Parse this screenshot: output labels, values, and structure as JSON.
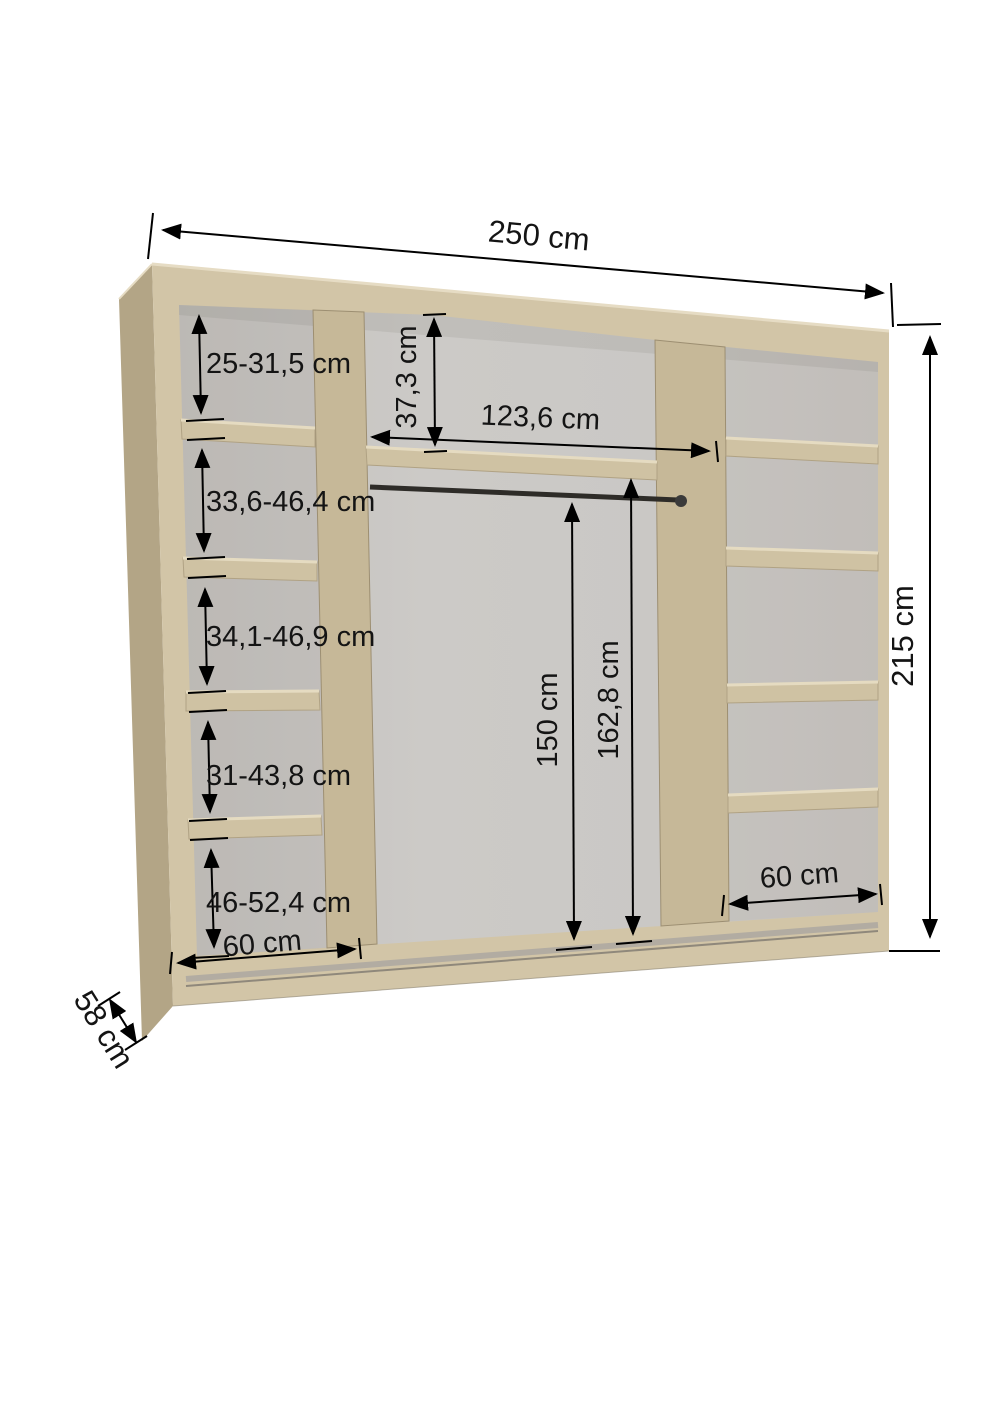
{
  "title": "Wardrobe interior dimensions diagram",
  "labels": {
    "overall_width": "250 cm",
    "overall_height": "215 cm",
    "depth": "58 cm",
    "left_shelf_heights": [
      "25-31,5 cm",
      "33,6-46,4 cm",
      "34,1-46,9 cm",
      "31-43,8 cm",
      "46-52,4 cm"
    ],
    "left_column_width": "60 cm",
    "top_compartment_height": "37,3 cm",
    "middle_width": "123,6 cm",
    "rod_height": "150 cm",
    "middle_interior_height": "162,8 cm",
    "right_column_width": "60 cm"
  },
  "colors": {
    "wood_front": "#d2c5a7",
    "wood_side": "#b3a586",
    "wood_shelf": "#cfc2a3",
    "wood_divider": "#c6b898",
    "back_panel": "#c9c6c2",
    "track_grey": "#b2aca2",
    "rod_dark": "#2e2c28",
    "dimension": "#000000",
    "text": "#141414"
  }
}
